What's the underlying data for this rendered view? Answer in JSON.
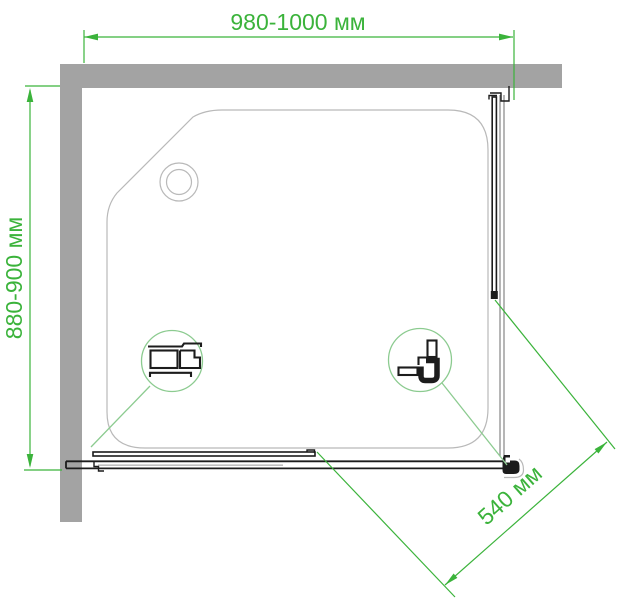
{
  "dimensions": {
    "width": {
      "label": "980-1000 мм"
    },
    "depth": {
      "label": "880-900 мм"
    },
    "door_opening": {
      "label": "540 мм"
    }
  },
  "colors": {
    "dimension_green": "#3bb33b",
    "callout_green": "#8ccb90",
    "wall_gray": "#a3a3a3",
    "profile_dark": "#1c1c1c",
    "glass_gray": "#8f8f8f",
    "tray_line": "#b9b9b9",
    "track_light": "#bfbfbf"
  },
  "icons": {
    "drain": "drain-icon",
    "left_detail": "wall-profile-section-icon",
    "right_detail": "corner-connector-section-icon"
  }
}
